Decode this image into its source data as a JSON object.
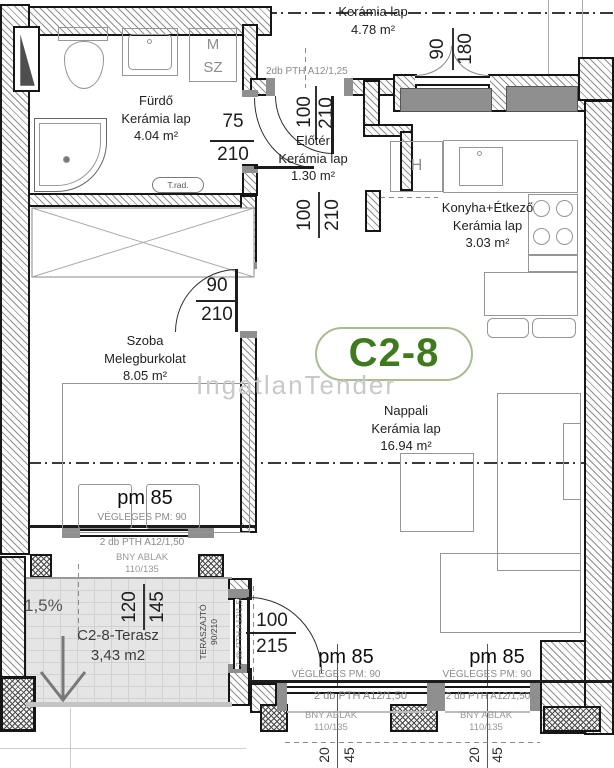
{
  "unit_label": "C2-8",
  "watermark": "IngatlanTender",
  "rooms": {
    "corridor": {
      "floor": "Kerámia lap",
      "area": "4.78 m²"
    },
    "furdo": {
      "name": "Fürdő",
      "floor": "Kerámia lap",
      "area": "4.04 m²"
    },
    "eloter": {
      "name": "Előtér",
      "floor": "Kerámia lap",
      "area": "1.30 m²"
    },
    "konyha": {
      "name": "Konyha+Étkező",
      "floor": "Kerámia lap",
      "area": "3.03 m²"
    },
    "szoba": {
      "name": "Szoba",
      "floor": "Melegburkolat",
      "area": "8.05 m²"
    },
    "nappali": {
      "name": "Nappali",
      "floor": "Kerámia lap",
      "area": "16.94 m²"
    },
    "terasz": {
      "name": "C2-8-Terasz",
      "area": "3,43 m2",
      "slope": "1,5%"
    }
  },
  "fixtures": {
    "m": "M",
    "sz": "SZ",
    "h": "H",
    "t_rad": "T.rad."
  },
  "dims": {
    "bath_door_w": "75",
    "bath_door_h": "210",
    "entry_door_w": "100",
    "entry_door_h": "210",
    "eloter_pass_w": "100",
    "eloter_pass_h": "210",
    "szoba_door_w": "90",
    "szoba_door_h": "210",
    "konyha_window_w": "90",
    "konyha_window_h": "180",
    "terasz_w": "120",
    "terasz_h": "145",
    "terasz_door_w": "100",
    "terasz_door_h": "215",
    "parapet_a_w": "20",
    "parapet_a_h": "45",
    "parapet_b_w": "20",
    "parapet_b_h": "45"
  },
  "annotations": {
    "lintel_entry": "2db PTH A12/1,25",
    "lintel_szoba": "2 db PTH A12/1,50",
    "lintel_nappali_1": "2 db PTH A12/1,50",
    "lintel_nappali_2": "2 db PTH A12/1,50",
    "lintel_terasz": "2 db PTH A12/1,50",
    "terasz_door_label": "TERASZAJTÓ",
    "terasz_door_size": "90/210",
    "sill_szoba_pm": "pm 85",
    "sill_szoba_final": "VÉGLEGES PM: 90",
    "sill_nappali_1_pm": "pm 85",
    "sill_nappali_1_final": "VÉGLEGES PM: 90",
    "sill_nappali_2_pm": "pm 85",
    "sill_nappali_2_final": "VÉGLEGES PM: 90",
    "window_szoba_type": "BNY ABLAK",
    "window_szoba_size": "110/135",
    "window_nappali_1_type": "BNY ABLAK",
    "window_nappali_1_size": "110/135",
    "window_nappali_2_type": "BNY ABLAK",
    "window_nappali_2_size": "110/135"
  },
  "colors": {
    "accent_green": "#3f7a1e",
    "pill_border": "#aabd92",
    "wall_black": "#161616",
    "sill_gray": "#8f8f8f",
    "watermark_gray": "#c9c9c9",
    "terrace_paving": "#e5e5e5"
  }
}
